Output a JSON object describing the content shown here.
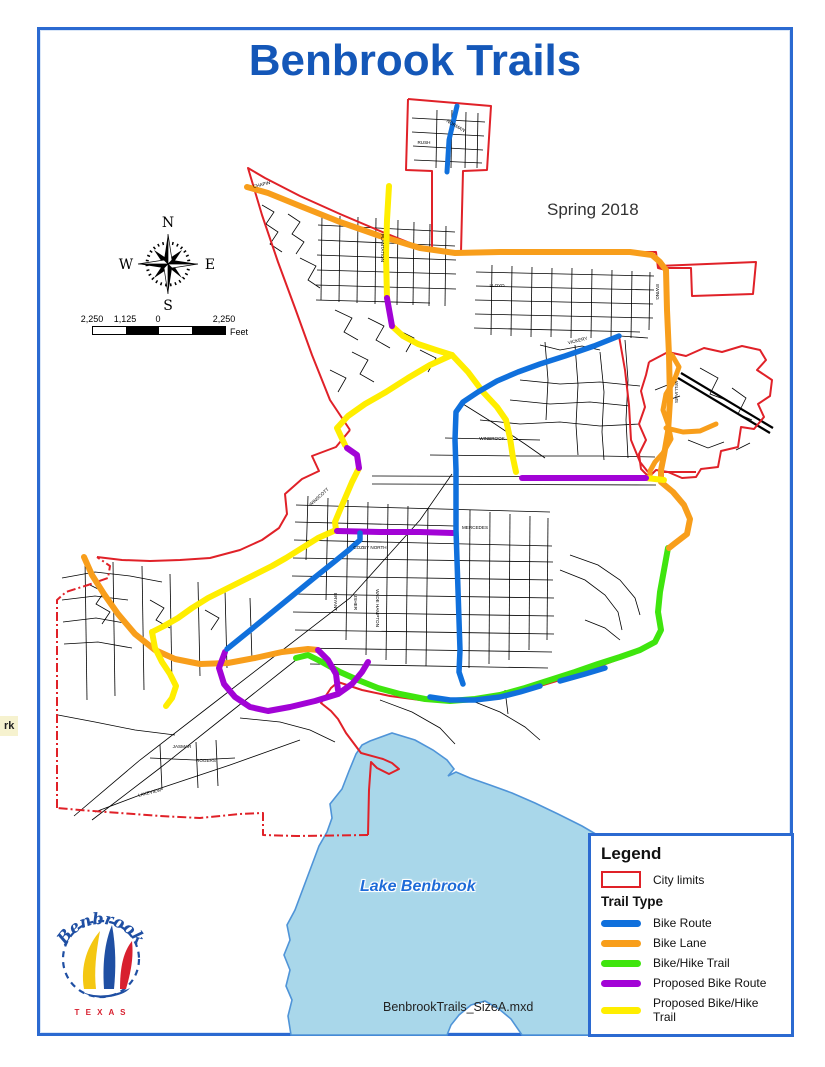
{
  "title": "Benbrook Trails",
  "subtitle": "Spring 2018",
  "footer_file": "BenbrookTrails_SizeA.mxd",
  "edge_label": "rk",
  "lake_label": "Lake Benbrook",
  "compass": {
    "n": "N",
    "s": "S",
    "e": "E",
    "w": "W"
  },
  "scalebar": {
    "labels": [
      "2,250",
      "1,125",
      "0",
      "2,250"
    ],
    "unit": "Feet"
  },
  "legend": {
    "title": "Legend",
    "city_limits_label": "City limits",
    "trail_type_label": "Trail Type",
    "items": [
      {
        "label": "Bike Route",
        "type": "route"
      },
      {
        "label": "Bike Lane",
        "type": "lane"
      },
      {
        "label": "Bike/Hike Trail",
        "type": "hike"
      },
      {
        "label": "Proposed Bike Route",
        "type": "prop_route"
      },
      {
        "label": "Proposed Bike/Hike Trail",
        "type": "prop_hike"
      }
    ]
  },
  "logo": {
    "name": "Benbrook",
    "sub": "T E X A S"
  },
  "colors": {
    "title_blue": "#1457b8",
    "frame_blue": "#2b6ad1",
    "city_limits": "#e02128",
    "route": "#1070dc",
    "lane": "#f89e1b",
    "hike": "#3fe50e",
    "prop_route": "#a203d6",
    "prop_hike": "#ffee00",
    "lake_fill": "#a9d7ea",
    "lake_stroke": "#4f94d8",
    "street": "#000000"
  },
  "map": {
    "lake": "370,741 392,733 415,740 433,750 447,760 454,769 448,776 456,772 470,778 490,785 512,793 535,803 558,814 582,826 606,840 630,855 652,870 673,888 692,908 707,928 716,947 722,941 736,946 750,955 757,968 745,976 727,972 712,978 700,988 688,1001 677,1012 669,1023 665,1035 522,1035 511,1019 499,1009 485,1001 471,1005 459,1015 451,1025 447,1035 291,1035 288,1016 292,1000 286,986 290,970 284,955 290,940 287,925 295,910 301,894 307,878 313,862 319,846 327,832 332,818 330,804 342,789 349,771 356,754 362,745",
    "streets": [
      "412,118 485,122",
      "412,132 484,136",
      "413,146 483,150",
      "414,160 482,163",
      "437,110 436,168",
      "452,110 451,168",
      "466,112 465,168",
      "478,113 477,168",
      "322,215 321,300",
      "340,216 339,302",
      "358,217 357,303",
      "376,218 375,304",
      "398,220 397,305",
      "414,222 413,305",
      "430,224 429,306",
      "446,226 445,306",
      "318,225 455,232",
      "318,240 455,246",
      "317,255 456,260",
      "317,270 456,274",
      "316,285 456,289",
      "316,300 430,303",
      "262,205 274,212 266,224 278,232 270,244 282,252",
      "288,214 300,222 292,234 304,242 296,254",
      "300,258 316,266 308,280 320,288",
      "335,310 352,318 344,332 358,340",
      "368,318 384,326 376,340 390,348",
      "398,330 414,338 406,352",
      "420,350 436,358 428,372",
      "352,352 368,360 360,374 374,382",
      "330,370 346,378 338,392",
      "492,265 491,335",
      "512,266 511,336",
      "532,267 531,337",
      "552,268 551,337",
      "572,268 571,338",
      "592,269 591,338",
      "612,270 611,338",
      "632,271 631,338",
      "650,272 649,330",
      "476,272 654,276",
      "476,286 654,290",
      "475,300 653,304",
      "475,314 653,318",
      "474,328 640,332",
      "540,345 560,350 582,346 600,350",
      "545,342 548,380 546,420",
      "575,345 578,385 576,425 578,455",
      "600,352 604,392 602,432 604,460",
      "625,340 628,380 626,420 628,458",
      "520,380 560,384 600,382 640,386",
      "510,400 550,404 590,402 630,406",
      "480,420 520,424 560,422 600,426 640,424",
      "445,438 540,440",
      "430,455 520,456 600,456 655,457",
      "372,476 660,477",
      "372,484 656,485",
      "497,380 560,356 620,336 648,338",
      "463,404 495,424 525,444 545,458",
      "308,496 306,560",
      "328,498 326,600",
      "348,500 346,640",
      "368,502 366,655",
      "388,504 386,660",
      "408,506 406,664",
      "428,508 426,666",
      "470,510 469,668",
      "490,512 489,664",
      "510,514 509,660",
      "530,516 529,650",
      "548,518 547,640",
      "296,505 550,512",
      "295,522 455,526",
      "294,540 552,546",
      "293,558 553,562",
      "292,576 553,580",
      "292,594 554,598",
      "293,612 554,616",
      "295,630 554,634",
      "300,648 552,652",
      "310,664 548,668",
      "560,570 585,580 605,595 618,612 622,630",
      "570,555 598,565 620,580 635,598 640,615",
      "585,620 605,628 620,640",
      "62,578 95,572 130,576 162,582",
      "62,600 95,596 128,600",
      "63,622 96,618 130,624",
      "64,644 98,642 132,648",
      "85,560 87,700",
      "113,562 115,696",
      "142,566 144,690",
      "170,574 172,684",
      "198,582 200,676",
      "225,590 227,668",
      "250,598 252,660",
      "90,585 104,592 96,604 110,612 102,624",
      "150,600 164,608 156,620 170,628",
      "205,610 219,618 211,630",
      "58,715 95,722 135,730 175,735",
      "95,812 140,795 185,780 230,765 272,750 300,740",
      "150,758 195,760 235,758",
      "196,742 198,788",
      "216,740 218,786",
      "160,745 162,790",
      "240,718 280,722 310,730 335,742",
      "74,816 140,760 210,706 280,652 350,598 420,520 452,474",
      "92,820 160,768 228,714 296,660",
      "380,700 412,712 440,728 455,744",
      "470,700 500,712 525,727 540,740",
      "505,690 508,714",
      "655,390 670,384 668,400 680,396",
      "700,368 718,378 710,394 726,400",
      "732,388 746,398 738,414 752,420",
      "688,440 708,448 724,442",
      "736,450 750,443"
    ],
    "highways": [
      "678,378 770,433",
      "681,373 773,428"
    ],
    "boundary": [
      {
        "pts": "408,99 491,106 487,170 463,171 461,252"
      },
      {
        "pts": "408,99 406,170 432,171 432,252"
      },
      {
        "pts": "350,430 330,400 312,355 295,308 278,262 262,215 248,168 265,178 300,196 340,214 380,231 420,247 432,251"
      },
      {
        "pts": "463,252 560,252 656,252 658,268 666,270"
      },
      {
        "pts": "658,266 756,262 753,294 692,296 691,268 658,268"
      },
      {
        "pts": "666,270 667,310 669,355 670,400 668,432 664,455 662,470 661,482 672,492 684,505 690,519 687,534 674,544 669,548 664,570 660,592 658,612 661,630 655,642"
      },
      {
        "pts": "655,642 630,655 600,666 570,677 540,686 510,694 480,699 450,702 420,700 390,696 362,690 338,682 331,688 321,703 331,711 338,719 346,733 361,753 383,759 392,763 399,769 389,774 377,768 371,762 369,790 368,835"
      },
      {
        "pts": "368,835 297,836 263,835 263,813 240,814 200,818 160,816 120,813 80,810 57,808",
        "dash": true
      },
      {
        "pts": "57,808 57,700 57,600 66,592 88,585 108,578 110,566 97,557",
        "dash": true
      },
      {
        "pts": "97,557 122,560 150,561 180,560 210,558 240,550 262,540 279,528 287,514 285,494 302,479 319,471 312,456 336,447 350,430"
      },
      {
        "pts": "662,472 696,472"
      },
      {
        "pts": "619,336 594,346 565,356 540,364 518,372 497,381 478,392 463,402 456,410"
      },
      {
        "pts": "619,336 625,370 629,405 631,440 640,462 648,472"
      },
      {
        "pts": "649,362 668,352 686,356 704,348 722,352 742,346 760,350 766,360 757,370 772,380 770,396 758,404 764,417 754,429 741,427 738,447 721,451 718,467 701,469 696,477 682,478 668,472 656,470 649,477 641,469 639,454 646,440 639,424 645,407 641,391 646,375 649,362"
      }
    ],
    "trails": [
      {
        "type": "hike",
        "w": 6,
        "pts": "668,548 664,570 660,592 658,612 661,630 655,642 640,650 620,657 598,664 575,672 550,680 525,688 500,695 475,699 450,701 425,699 400,694 378,688 358,680 340,672 322,662 308,655 296,658"
      },
      {
        "type": "lane",
        "w": 6,
        "pts": "247,187 268,193 300,206 340,222 380,236 420,248 455,253 500,252 545,252 590,252 630,252 652,255 660,262 666,270 667,310 669,355 670,400 668,432 664,455 661,470 661,480"
      },
      {
        "type": "lane",
        "w": 6,
        "pts": "661,482 673,492 684,505 690,519 687,534 674,544 669,548"
      },
      {
        "type": "lane",
        "w": 5,
        "pts": "672,355 679,367 674,381 666,394 663,410 668,424 671,439 663,453 655,462 650,471 650,479"
      },
      {
        "type": "lane",
        "w": 5,
        "pts": "666,428 683,432 700,431 716,424"
      },
      {
        "type": "lane",
        "w": 6,
        "pts": "84,557 92,575 104,594 118,614 135,634 155,650 175,659 200,664 228,663 255,658 282,652 308,649 318,650"
      },
      {
        "type": "prop_hike",
        "w": 6,
        "pts": "389,186 387,220 386,255 387,298"
      },
      {
        "type": "prop_hike",
        "w": 6,
        "pts": "392,326 403,336 418,344 436,350 452,355"
      },
      {
        "type": "prop_hike",
        "w": 6,
        "pts": "452,355 468,372 483,392 497,407 506,420 510,438 513,458 516,472"
      },
      {
        "type": "prop_hike",
        "w": 6,
        "pts": "452,355 430,365 408,378 386,392 365,404 348,416 337,428 345,445"
      },
      {
        "type": "prop_hike",
        "w": 6,
        "pts": "359,468 352,482 346,496 340,510 335,522 336,530"
      },
      {
        "type": "prop_hike",
        "w": 6,
        "pts": "336,530 318,538 302,548 286,558 272,566 256,574 240,582 224,590 208,598 192,608 178,618 164,626 152,632"
      },
      {
        "type": "prop_hike",
        "w": 6,
        "pts": "152,632 155,648 162,662 170,674 176,686 172,698 166,706"
      },
      {
        "type": "prop_hike",
        "w": 6,
        "pts": "646,478 664,480"
      },
      {
        "type": "prop_route",
        "w": 6,
        "pts": "387,298 392,326"
      },
      {
        "type": "prop_route",
        "w": 6,
        "pts": "347,448 357,455 359,468"
      },
      {
        "type": "prop_route",
        "w": 6,
        "pts": "337,531 380,532 420,532 453,533"
      },
      {
        "type": "prop_route",
        "w": 6,
        "pts": "522,478 560,478 600,478 646,478"
      },
      {
        "type": "prop_route",
        "w": 6,
        "pts": "225,652 219,668 224,684 235,697 250,707 268,711 290,707 315,701 338,694 352,684 362,672 368,662"
      },
      {
        "type": "prop_route",
        "w": 6,
        "pts": "318,650 328,660 336,674 338,690"
      },
      {
        "type": "route",
        "w": 5,
        "pts": "457,106 449,140 447,172"
      },
      {
        "type": "route",
        "w": 5.5,
        "pts": "619,336 594,346 565,356 540,364 518,372 497,381 478,392 463,402 456,412 455,440 456,470 456,500 456,530 457,560 458,590 459,620 460,650 459,672 463,684"
      },
      {
        "type": "route",
        "w": 5.5,
        "pts": "430,697 450,700 475,700 500,697 520,692 540,686"
      },
      {
        "type": "route",
        "w": 5.5,
        "pts": "560,681 585,674 605,668"
      },
      {
        "type": "route",
        "w": 5.5,
        "pts": "227,649 248,632 270,614 292,596 314,578 334,562 350,549 360,540 360,533"
      }
    ],
    "street_labels": [
      {
        "t": "NORMAN",
        "x": 455,
        "y": 127,
        "r": 30
      },
      {
        "t": "RUSH",
        "x": 424,
        "y": 144,
        "r": 0
      },
      {
        "t": "CHAPIN",
        "x": 262,
        "y": 186,
        "r": -14
      },
      {
        "t": "PLANTATION",
        "x": 381,
        "y": 248,
        "r": 90
      },
      {
        "t": "LLOYD",
        "x": 497,
        "y": 287,
        "r": 0
      },
      {
        "t": "EWING",
        "x": 656,
        "y": 292,
        "r": 90
      },
      {
        "t": "WILLIAMS",
        "x": 675,
        "y": 392,
        "r": 90
      },
      {
        "t": "VICKERY",
        "x": 578,
        "y": 342,
        "r": -14
      },
      {
        "t": "WINBROOK",
        "x": 492,
        "y": 440,
        "r": 0
      },
      {
        "t": "MERCEDES",
        "x": 475,
        "y": 529,
        "r": 0
      },
      {
        "t": "COZBY NORTH",
        "x": 370,
        "y": 549,
        "r": 0
      },
      {
        "t": "WINSCOTT",
        "x": 320,
        "y": 498,
        "r": -42
      },
      {
        "t": "BRYANT",
        "x": 334,
        "y": 602,
        "r": 90
      },
      {
        "t": "USHER",
        "x": 354,
        "y": 602,
        "r": 90
      },
      {
        "t": "WADE HAMPTON",
        "x": 376,
        "y": 608,
        "r": 90
      },
      {
        "t": "JASMAR",
        "x": 182,
        "y": 748,
        "r": 0
      },
      {
        "t": "ROGERS",
        "x": 206,
        "y": 762,
        "r": 0
      },
      {
        "t": "LAKEVIEW",
        "x": 150,
        "y": 794,
        "r": -14
      }
    ]
  }
}
